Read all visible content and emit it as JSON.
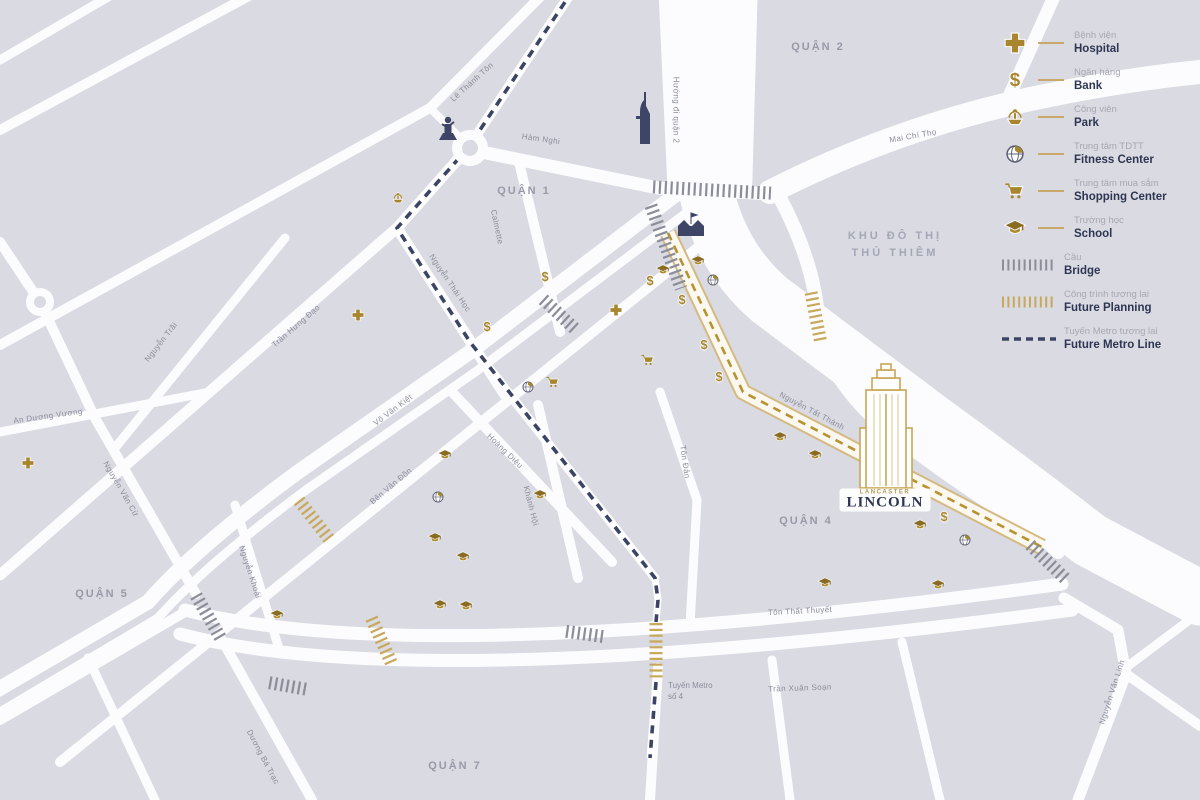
{
  "map": {
    "background_color": "#d9dae2",
    "road_color": "#fcfcfe",
    "accent_gold": "#a8862e",
    "navy": "#3c4466",
    "future_gold": "#c8a85a",
    "districts": [
      {
        "name": "Quận 2",
        "x": 818,
        "y": 47
      },
      {
        "name": "Quận 1",
        "x": 524,
        "y": 191
      },
      {
        "name": "Quận 4",
        "x": 806,
        "y": 521
      },
      {
        "name": "Quận 5",
        "x": 102,
        "y": 594
      },
      {
        "name": "Quận 7",
        "x": 455,
        "y": 766
      }
    ],
    "area_label": {
      "line1": "Khu đô thị",
      "line2": "Thủ Thiêm",
      "x": 895,
      "y": 245
    },
    "streets": [
      {
        "text": "Lê Thánh Tôn",
        "x": 472,
        "y": 82,
        "rot": -42
      },
      {
        "text": "Hàm Nghi",
        "x": 541,
        "y": 139,
        "rot": 8
      },
      {
        "text": "Hướng đi quận 2",
        "x": 676,
        "y": 110,
        "rot": 90
      },
      {
        "text": "Mai Chí Thọ",
        "x": 913,
        "y": 136,
        "rot": -10
      },
      {
        "text": "Calmette",
        "x": 497,
        "y": 227,
        "rot": 78
      },
      {
        "text": "Nguyễn Thái Học",
        "x": 450,
        "y": 283,
        "rot": 56
      },
      {
        "text": "Trần Hưng Đạo",
        "x": 296,
        "y": 326,
        "rot": -41
      },
      {
        "text": "Nguyễn Trãi",
        "x": 161,
        "y": 342,
        "rot": -52
      },
      {
        "text": "An Dương Vương",
        "x": 48,
        "y": 416,
        "rot": -8
      },
      {
        "text": "Nguyễn Văn Cừ",
        "x": 121,
        "y": 489,
        "rot": 60
      },
      {
        "text": "Võ Văn Kiệt",
        "x": 393,
        "y": 410,
        "rot": -37
      },
      {
        "text": "Bến Vân Đồn",
        "x": 391,
        "y": 486,
        "rot": -40
      },
      {
        "text": "Hoàng Diệu",
        "x": 505,
        "y": 451,
        "rot": 44
      },
      {
        "text": "Khánh Hội",
        "x": 531,
        "y": 506,
        "rot": 76
      },
      {
        "text": "Nguyễn Khoái",
        "x": 250,
        "y": 572,
        "rot": 72
      },
      {
        "text": "Tôn Đản",
        "x": 685,
        "y": 462,
        "rot": 82
      },
      {
        "text": "Nguyễn Tất Thành",
        "x": 812,
        "y": 411,
        "rot": 28
      },
      {
        "text": "Tôn Thất Thuyết",
        "x": 800,
        "y": 611,
        "rot": -3
      },
      {
        "text": "Trần Xuân Soạn",
        "x": 800,
        "y": 688,
        "rot": -2
      },
      {
        "text": "Nguyễn Văn Linh",
        "x": 1112,
        "y": 692,
        "rot": -72
      },
      {
        "text": "Dương Bá Trạc",
        "x": 263,
        "y": 757,
        "rot": 62
      }
    ],
    "metro_label": {
      "line1": "Tuyến Metro",
      "line2": "số 4"
    },
    "landmark": {
      "brand": "LANCASTER",
      "name": "LINCOLN",
      "x": 885,
      "y": 500
    },
    "icons": {
      "hospital": [
        [
          616,
          310
        ],
        [
          358,
          315
        ],
        [
          28,
          463
        ]
      ],
      "bank": [
        [
          545,
          277
        ],
        [
          487,
          327
        ],
        [
          650,
          281
        ],
        [
          682,
          300
        ],
        [
          704,
          345
        ],
        [
          719,
          377
        ],
        [
          944,
          517
        ]
      ],
      "park": [
        [
          398,
          198
        ]
      ],
      "fitness": [
        [
          713,
          280
        ],
        [
          528,
          387
        ],
        [
          438,
          497
        ],
        [
          965,
          540
        ]
      ],
      "shopping": [
        [
          553,
          382
        ],
        [
          648,
          360
        ]
      ],
      "school": [
        [
          698,
          261
        ],
        [
          663,
          270
        ],
        [
          445,
          455
        ],
        [
          540,
          495
        ],
        [
          435,
          538
        ],
        [
          463,
          557
        ],
        [
          440,
          605
        ],
        [
          466,
          606
        ],
        [
          277,
          615
        ],
        [
          780,
          437
        ],
        [
          815,
          455
        ],
        [
          920,
          525
        ],
        [
          825,
          583
        ],
        [
          938,
          585
        ]
      ]
    },
    "bridges": {
      "gray": [
        [
          712,
          190,
          3,
          118
        ],
        [
          666,
          247,
          70,
          88
        ],
        [
          560,
          315,
          43,
          46
        ],
        [
          209,
          618,
          60,
          52
        ],
        [
          288,
          686,
          10,
          38
        ],
        [
          585,
          634,
          8,
          38
        ],
        [
          1048,
          562,
          44,
          50
        ]
      ],
      "gold": [
        [
          816,
          318,
          79,
          52
        ],
        [
          315,
          521,
          52,
          52
        ],
        [
          382,
          642,
          66,
          52
        ],
        [
          656,
          652,
          90,
          58
        ]
      ]
    }
  },
  "legend": {
    "items": [
      {
        "type": "hospital",
        "vn": "Bệnh viện",
        "en": "Hospital"
      },
      {
        "type": "bank",
        "vn": "Ngân hàng",
        "en": "Bank"
      },
      {
        "type": "park",
        "vn": "Công viên",
        "en": "Park"
      },
      {
        "type": "fitness",
        "vn": "Trung tâm TDTT",
        "en": "Fitness Center"
      },
      {
        "type": "shopping",
        "vn": "Trung tâm mua sắm",
        "en": "Shopping Center"
      },
      {
        "type": "school",
        "vn": "Trường học",
        "en": "School"
      },
      {
        "type": "bridge",
        "vn": "Cầu",
        "en": "Bridge"
      },
      {
        "type": "future",
        "vn": "Công trình tương lai",
        "en": "Future Planning"
      },
      {
        "type": "metro",
        "vn": "Tuyến Metro tương lai",
        "en": "Future Metro Line"
      }
    ]
  }
}
